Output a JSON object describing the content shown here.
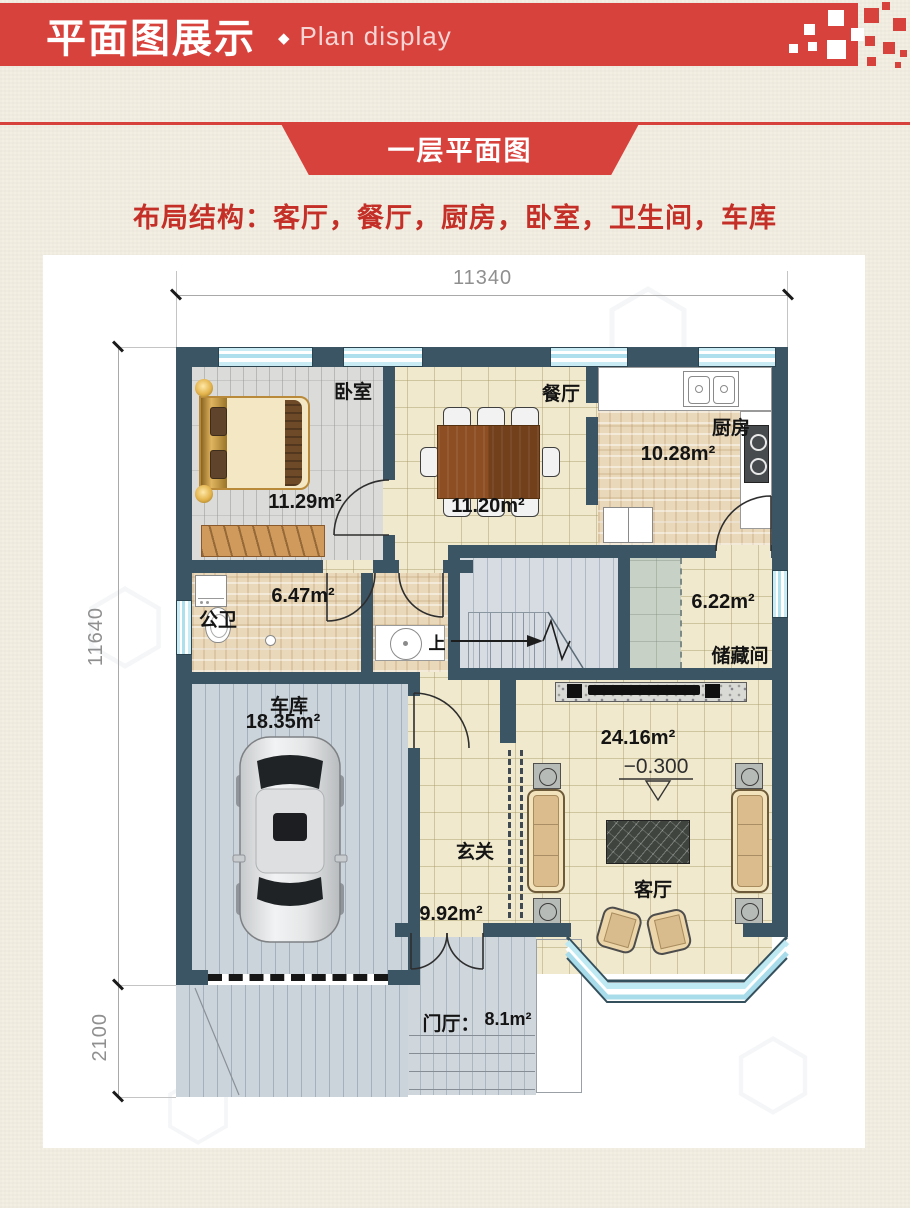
{
  "header": {
    "title_cn": "平面图展示",
    "separator": "◆",
    "title_en": "Plan display"
  },
  "ribbon": {
    "label": "一层平面图"
  },
  "intro": {
    "text": "布局结构：客厅，餐厅，厨房，卧室，卫生间，车库"
  },
  "dimensions": {
    "top": "11340",
    "side": "11640",
    "front": "2100"
  },
  "rooms": {
    "bedroom": {
      "name": "卧室",
      "area": "11.29m²"
    },
    "dining": {
      "name": "餐厅",
      "area": "11.20m²"
    },
    "kitchen": {
      "name": "厨房",
      "area": "10.28m²"
    },
    "bathroom": {
      "name": "公卫",
      "area": "6.47m²"
    },
    "storage": {
      "name": "储藏间",
      "area": "6.22m²"
    },
    "garage": {
      "name": "车库",
      "area": "18.35m²"
    },
    "foyer": {
      "name": "玄关",
      "area": "9.92m²"
    },
    "living": {
      "name": "客厅",
      "area": "24.16m²",
      "level": "−0.300"
    },
    "porch": {
      "name": "门厅：",
      "area": "8.1m²"
    }
  },
  "stairs": {
    "up": "上"
  },
  "colors": {
    "banner_red": "#d8423d",
    "text_red": "#c42f27",
    "wall": "#3c5565",
    "window_glass": "#c9ecf4"
  }
}
